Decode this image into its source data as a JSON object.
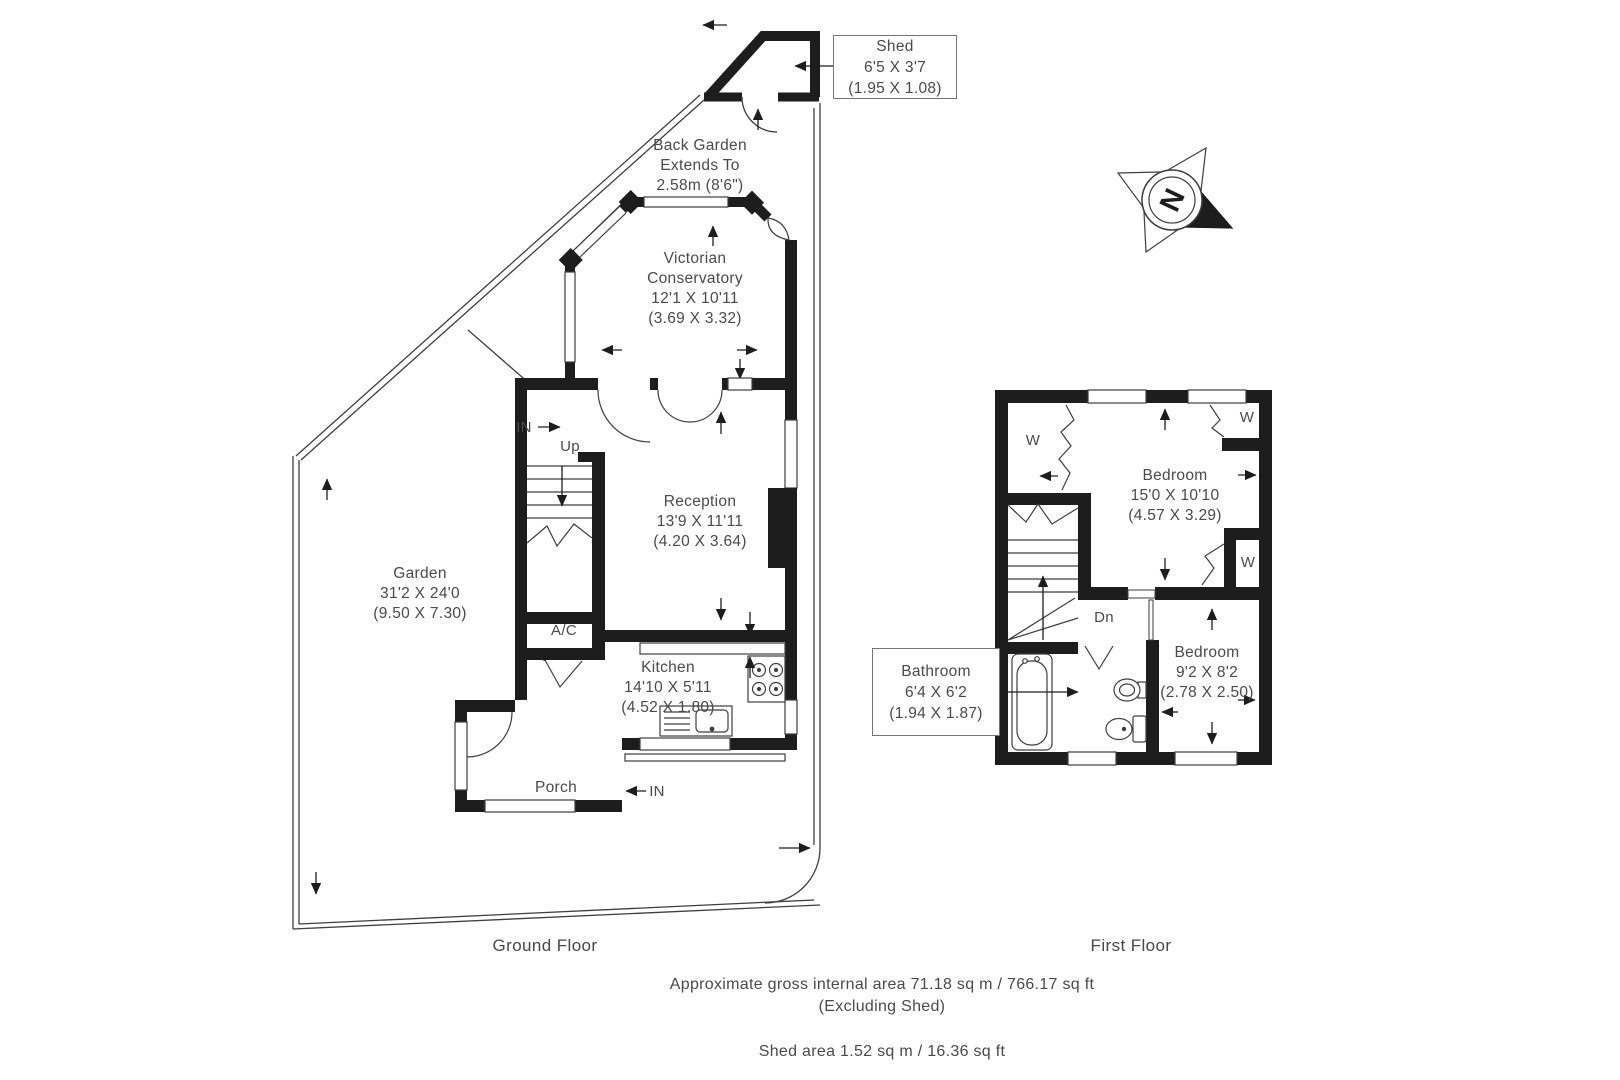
{
  "colors": {
    "wall": "#1d1d1d",
    "line": "#3e3e3e",
    "text": "#4a4a4a",
    "box_border": "#757575",
    "background": "#ffffff"
  },
  "compass": {
    "north": "N"
  },
  "ground_floor": {
    "title": "Ground Floor",
    "back_garden": {
      "line1": "Back Garden",
      "line2": "Extends To",
      "line3": "2.58m (8'6\")"
    },
    "shed": {
      "name": "Shed",
      "imperial": "6'5 X 3'7",
      "metric": "(1.95 X 1.08)"
    },
    "conservatory": {
      "name1": "Victorian",
      "name2": "Conservatory",
      "imperial": "12'1 X 10'11",
      "metric": "(3.69 X 3.32)"
    },
    "reception": {
      "name": "Reception",
      "imperial": "13'9 X 11'11",
      "metric": "(4.20 X 3.64)"
    },
    "kitchen": {
      "name": "Kitchen",
      "imperial": "14'10 X 5'11",
      "metric": "(4.52 X 1.80)"
    },
    "garden": {
      "name": "Garden",
      "imperial": "31'2 X 24'0",
      "metric": "(9.50 X 7.30)"
    },
    "porch": {
      "name": "Porch"
    },
    "stairs": "Up",
    "ac": "A/C",
    "entrance_in": "IN",
    "porch_in": "IN"
  },
  "first_floor": {
    "title": "First Floor",
    "bedroom1": {
      "name": "Bedroom",
      "imperial": "15'0 X 10'10",
      "metric": "(4.57 X 3.29)"
    },
    "bedroom2": {
      "name": "Bedroom",
      "imperial": "9'2 X 8'2",
      "metric": "(2.78 X 2.50)"
    },
    "bathroom": {
      "name": "Bathroom",
      "imperial": "6'4 X 6'2",
      "metric": "(1.94 X 1.87)"
    },
    "stairs": "Dn",
    "wardrobe": "W"
  },
  "footer": {
    "area_line": "Approximate gross internal area 71.18 sq m / 766.17 sq ft",
    "area_note": "(Excluding Shed)",
    "shed_area_line": "Shed area 1.52 sq m / 16.36 sq ft"
  }
}
